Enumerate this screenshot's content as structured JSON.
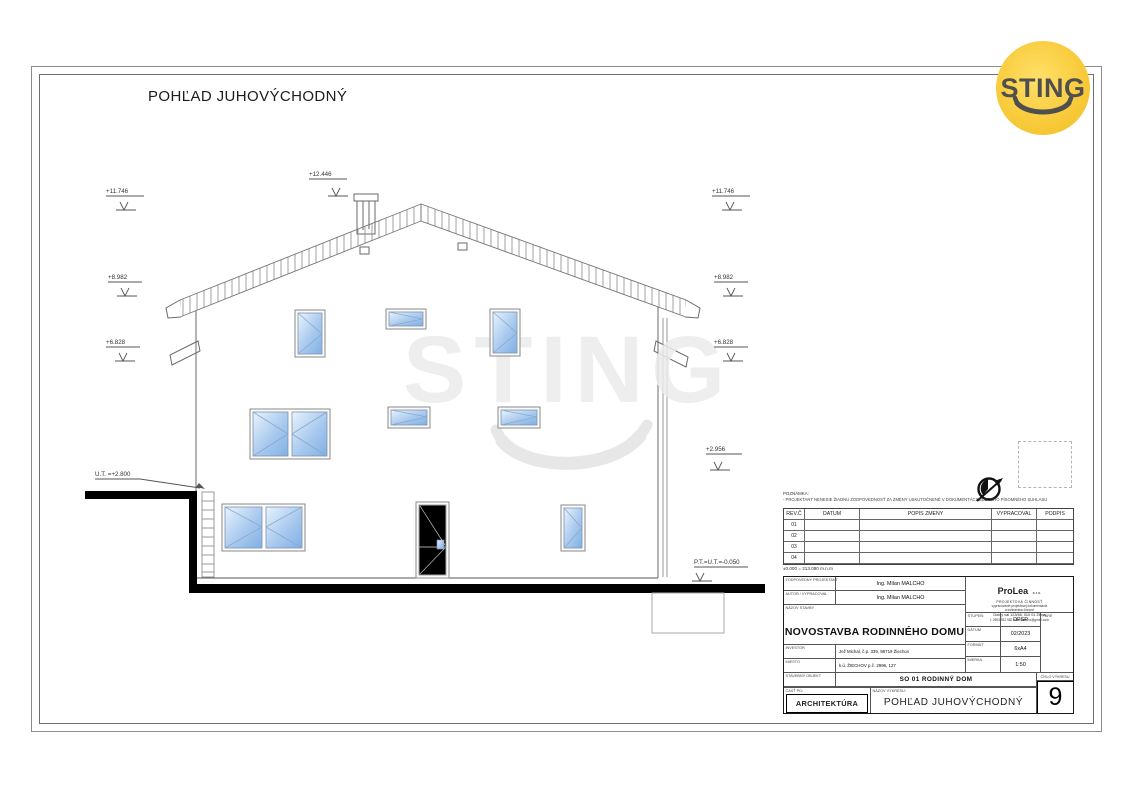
{
  "sheet": {
    "title": "POHĽAD JUHOVÝCHODNÝ"
  },
  "logo": {
    "text": "STING"
  },
  "watermark": {
    "text": "STING"
  },
  "markers": {
    "chimney_top": "+12.446",
    "left_1": "+11.746",
    "left_2": "+8.982",
    "left_3": "+6.828",
    "right_1": "+11.746",
    "right_2": "+8.982",
    "right_3": "+6.828",
    "right_4": "+2.956",
    "terrain_left": "U.T. =+2.800",
    "base_right": "P.T.=U.T.=-0.050"
  },
  "note": {
    "label": "POZNÁMKA:",
    "text": "- PROJEKTANT NENESIE ŽIADNU ZODPOVEDNOSŤ ZA ZMENY USKUTOČNENÉ V DOKUMENTÁCII BEZ JEHO PÍSOMNÉHO SÚHLASU"
  },
  "revision_table": {
    "headers": [
      "REV.Č",
      "DATUM",
      "POPIS ZMENY",
      "VYPRACOVAL",
      "PODPIS"
    ],
    "rows": [
      "01",
      "02",
      "03",
      "04"
    ]
  },
  "datum_note": "±0.000 = 213.080 m.n.m",
  "title_block": {
    "responsible_label": "ZODPOVEDNÝ PROJEKTANT",
    "responsible": "Ing. Milan MALCHO",
    "author_label": "AUTOR / VYPRACOVAL",
    "author": "Ing. Milan MALCHO",
    "project_label": "NÁZOV STAVBY",
    "project": "NOVOSTAVBA RODINNÉHO DOMU",
    "investor_label": "INVESTOR",
    "investor": "Jež Michal, č.p. 339, 98719 Žiechov",
    "place_label": "MIESTO",
    "place": "k.ú. ŽIECHOV p.č. 2996, 127",
    "object_label": "STAVEBNÝ OBJEKT",
    "object": "SO 01  RODINNÝ DOM",
    "part_label": "ČASŤ PD:",
    "part": "ARCHITEKTÚRA",
    "drawing_label": "NÁZOV VÝKRESU:",
    "drawing": "POHĽAD JUHOVÝCHODNÝ",
    "number_label": "ČÍSLO VÝKRESU",
    "number": "9",
    "stage_label": "STUPEŇ:",
    "stage": "DPSP",
    "date_label": "DÁTUM",
    "date": "02/2023",
    "format_label": "FORMÁT",
    "format": "6xA4",
    "scale_label": "MIERKA",
    "scale": "1:50",
    "pare_label": "PARÉ",
    "company": {
      "name": "ProLea",
      "suffix": "s.r.o.",
      "subtitle": "PROJEKTOVÁ ČINNOSŤ",
      "line1": "vypracovanie projektovej dokumentácie",
      "line2": "a inžinierska činnosť",
      "address": "Dolný val 123/58, 010 01 Žilina",
      "contact": "t. 0903 932 982   milanmalcho@gmail.com"
    }
  },
  "colors": {
    "logo_yellow": "#f7c836",
    "glass_blue": "#9cc2ea"
  }
}
